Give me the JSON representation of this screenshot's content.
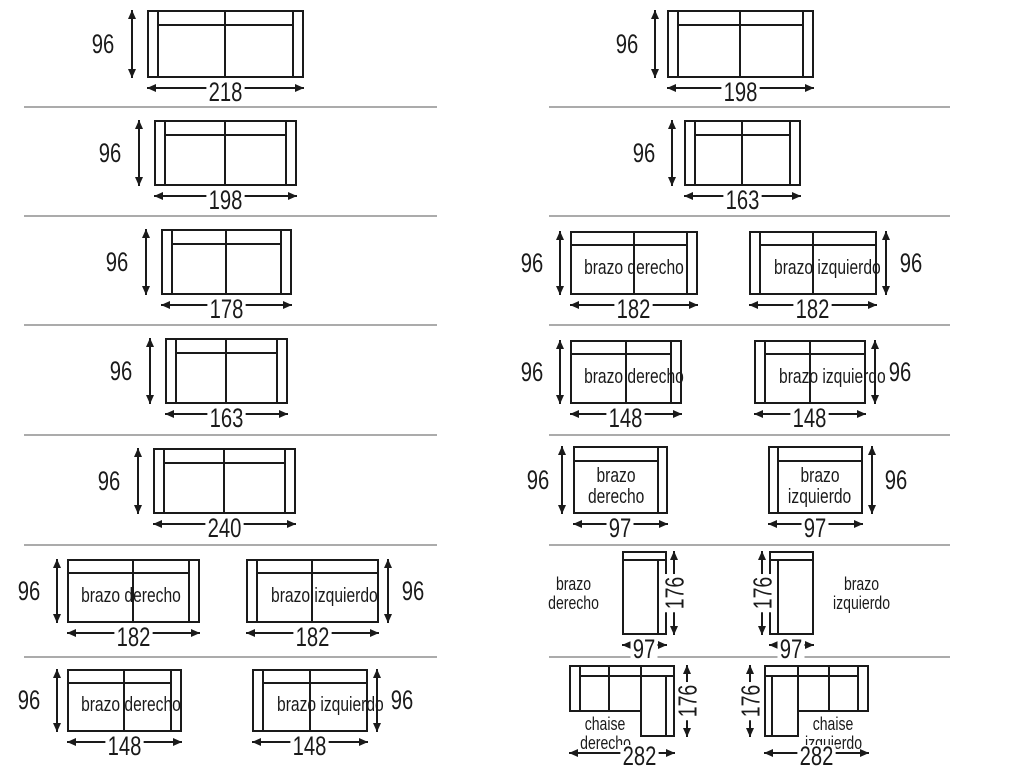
{
  "left_column": {
    "row1": {
      "width": "218",
      "depth": "96"
    },
    "row2": {
      "width": "198",
      "depth": "96"
    },
    "row3": {
      "width": "178",
      "depth": "96"
    },
    "row4": {
      "width": "163",
      "depth": "96"
    },
    "row5": {
      "width": "240",
      "depth": "96"
    },
    "row6": {
      "derecho": {
        "label": "brazo derecho",
        "width": "182",
        "depth": "96"
      },
      "izquierdo": {
        "label": "brazo izquierdo",
        "width": "182",
        "depth": "96"
      }
    },
    "row7": {
      "derecho": {
        "label": "brazo derecho",
        "width": "148",
        "depth": "96"
      },
      "izquierdo": {
        "label": "brazo izquierdo",
        "width": "148",
        "depth": "96"
      }
    }
  },
  "right_column": {
    "row1": {
      "width": "198",
      "depth": "96"
    },
    "row2": {
      "width": "163",
      "depth": "96"
    },
    "row3": {
      "derecho": {
        "label": "brazo derecho",
        "width": "182",
        "depth": "96"
      },
      "izquierdo": {
        "label": "brazo izquierdo",
        "width": "182",
        "depth": "96"
      }
    },
    "row4": {
      "derecho": {
        "label": "brazo derecho",
        "width": "148",
        "depth": "96"
      },
      "izquierdo": {
        "label": "brazo izquierdo",
        "width": "148",
        "depth": "96"
      }
    },
    "row5": {
      "derecho": {
        "label1": "brazo",
        "label2": "derecho",
        "width": "97",
        "depth": "96"
      },
      "izquierdo": {
        "label1": "brazo",
        "label2": "izquierdo",
        "width": "97",
        "depth": "96"
      }
    },
    "row6": {
      "derecho": {
        "label1": "brazo",
        "label2": "derecho",
        "width": "97",
        "length": "176"
      },
      "izquierdo": {
        "label1": "brazo",
        "label2": "izquierdo",
        "width": "97",
        "length": "176"
      }
    },
    "row7": {
      "derecho": {
        "label1": "chaise",
        "label2": "derecho",
        "width": "282",
        "length": "176"
      },
      "izquierdo": {
        "label1": "chaise",
        "label2": "izquierdo",
        "width": "282",
        "length": "176"
      }
    }
  },
  "colors": {
    "line": "#1a1a1a",
    "separator": "#ababab",
    "background": "#ffffff"
  }
}
